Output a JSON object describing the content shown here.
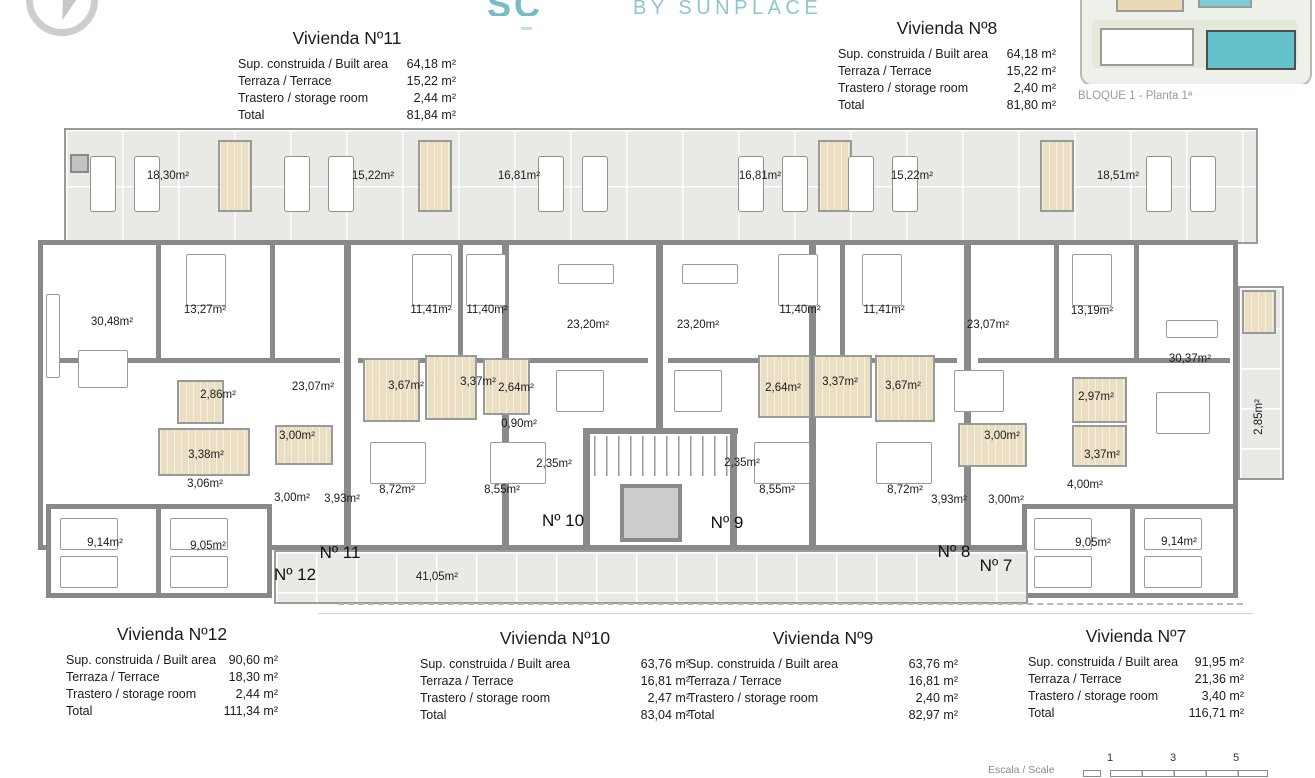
{
  "header": {
    "logo_partial": "SC",
    "logo_subtitle": "BY SUNPLACE",
    "brand_color": "#8fc6ce"
  },
  "site_map": {
    "caption": "BLOQUE 1 - Planta 1ª",
    "highlight_color": "#63c2cb"
  },
  "unit_tables": [
    {
      "title": "Vivienda Nº11",
      "rows": [
        [
          "Sup. construida / Built area",
          "64,18 m²"
        ],
        [
          "Terraza / Terrace",
          "15,22 m²"
        ],
        [
          "Trastero / storage room",
          "2,44 m²"
        ],
        [
          "Total",
          "81,84 m²"
        ]
      ]
    },
    {
      "title": "Vivienda Nº8",
      "rows": [
        [
          "Sup. construida / Built area",
          "64,18 m²"
        ],
        [
          "Terraza / Terrace",
          "15,22 m²"
        ],
        [
          "Trastero / storage room",
          "2,40 m²"
        ],
        [
          "Total",
          "81,80 m²"
        ]
      ]
    },
    {
      "title": "Vivienda Nº12",
      "rows": [
        [
          "Sup. construida / Built area",
          "90,60 m²"
        ],
        [
          "Terraza / Terrace",
          "18,30 m²"
        ],
        [
          "Trastero / storage room",
          "2,44 m²"
        ],
        [
          "Total",
          "111,34 m²"
        ]
      ]
    },
    {
      "title": "Vivienda Nº10",
      "rows": [
        [
          "Sup. construida / Built area",
          "63,76 m²"
        ],
        [
          "Terraza / Terrace",
          "16,81 m²"
        ],
        [
          "Trastero / storage room",
          "2,47 m²"
        ],
        [
          "Total",
          "83,04 m²"
        ]
      ]
    },
    {
      "title": "Vivienda Nº9",
      "rows": [
        [
          "Sup. construida / Built area",
          "63,76 m²"
        ],
        [
          "Terraza / Terrace",
          "16,81 m²"
        ],
        [
          "Trastero / storage room",
          "2,40 m²"
        ],
        [
          "Total",
          "82,97 m²"
        ]
      ]
    },
    {
      "title": "Vivienda Nº7",
      "rows": [
        [
          "Sup. construida / Built area",
          "91,95 m²"
        ],
        [
          "Terraza / Terrace",
          "21,36 m²"
        ],
        [
          "Trastero / storage room",
          "3,40 m²"
        ],
        [
          "Total",
          "116,71 m²"
        ]
      ]
    }
  ],
  "floor_plan": {
    "room_labels": [
      {
        "text": "18,30m²",
        "x": 130,
        "y": 50
      },
      {
        "text": "15,22m²",
        "x": 335,
        "y": 50
      },
      {
        "text": "16,81m²",
        "x": 481,
        "y": 50
      },
      {
        "text": "16,81m²",
        "x": 722,
        "y": 50
      },
      {
        "text": "15,22m²",
        "x": 874,
        "y": 50
      },
      {
        "text": "18,51m²",
        "x": 1080,
        "y": 50
      },
      {
        "text": "30,48m²",
        "x": 74,
        "y": 196
      },
      {
        "text": "13,27m²",
        "x": 167,
        "y": 184
      },
      {
        "text": "11,41m²",
        "x": 393,
        "y": 184
      },
      {
        "text": "11,40m²",
        "x": 449,
        "y": 184
      },
      {
        "text": "23,20m²",
        "x": 550,
        "y": 199
      },
      {
        "text": "23,20m²",
        "x": 660,
        "y": 199
      },
      {
        "text": "11,40m²",
        "x": 762,
        "y": 184
      },
      {
        "text": "11,41m²",
        "x": 846,
        "y": 184
      },
      {
        "text": "23,07m²",
        "x": 950,
        "y": 199
      },
      {
        "text": "13,19m²",
        "x": 1054,
        "y": 185
      },
      {
        "text": "30,37m²",
        "x": 1152,
        "y": 233
      },
      {
        "text": "23,07m²",
        "x": 275,
        "y": 261
      },
      {
        "text": "2,86m²",
        "x": 180,
        "y": 269
      },
      {
        "text": "3,67m²",
        "x": 368,
        "y": 260
      },
      {
        "text": "3,37m²",
        "x": 440,
        "y": 256
      },
      {
        "text": "2,64m²",
        "x": 478,
        "y": 262
      },
      {
        "text": "2,64m²",
        "x": 745,
        "y": 262
      },
      {
        "text": "3,37m²",
        "x": 802,
        "y": 256
      },
      {
        "text": "3,67m²",
        "x": 865,
        "y": 260
      },
      {
        "text": "2,97m²",
        "x": 1058,
        "y": 271
      },
      {
        "text": "0,90m²",
        "x": 481,
        "y": 298
      },
      {
        "text": "3,38m²",
        "x": 168,
        "y": 329
      },
      {
        "text": "3,00m²",
        "x": 259,
        "y": 310
      },
      {
        "text": "3,00m²",
        "x": 964,
        "y": 310
      },
      {
        "text": "3,37m²",
        "x": 1064,
        "y": 329
      },
      {
        "text": "2,35m²",
        "x": 516,
        "y": 338
      },
      {
        "text": "2,35m²",
        "x": 704,
        "y": 337
      },
      {
        "text": "3,06m²",
        "x": 167,
        "y": 358
      },
      {
        "text": "4,00m²",
        "x": 1047,
        "y": 359
      },
      {
        "text": "3,00m²",
        "x": 254,
        "y": 372
      },
      {
        "text": "3,93m²",
        "x": 304,
        "y": 373
      },
      {
        "text": "8,72m²",
        "x": 359,
        "y": 364
      },
      {
        "text": "8,55m²",
        "x": 464,
        "y": 364
      },
      {
        "text": "8,55m²",
        "x": 739,
        "y": 364
      },
      {
        "text": "8,72m²",
        "x": 867,
        "y": 364
      },
      {
        "text": "3,93m²",
        "x": 911,
        "y": 374
      },
      {
        "text": "3,00m²",
        "x": 968,
        "y": 374
      },
      {
        "text": "9,14m²",
        "x": 67,
        "y": 417
      },
      {
        "text": "9,05m²",
        "x": 170,
        "y": 420
      },
      {
        "text": "9,05m²",
        "x": 1055,
        "y": 417
      },
      {
        "text": "9,14m²",
        "x": 1141,
        "y": 416
      },
      {
        "text": "41,05m²",
        "x": 399,
        "y": 451
      }
    ],
    "unit_markers": [
      {
        "text": "Nº 12",
        "x": 257,
        "y": 449
      },
      {
        "text": "Nº 11",
        "x": 302,
        "y": 427
      },
      {
        "text": "Nº 10",
        "x": 525,
        "y": 395
      },
      {
        "text": "Nº 9",
        "x": 689,
        "y": 397
      },
      {
        "text": "Nº 8",
        "x": 916,
        "y": 426
      },
      {
        "text": "Nº 7",
        "x": 958,
        "y": 440
      }
    ],
    "vertical_label": "2,85m²"
  },
  "scale_bar": {
    "label": "Escala / Scale",
    "ticks": [
      "1",
      "3",
      "5"
    ]
  }
}
